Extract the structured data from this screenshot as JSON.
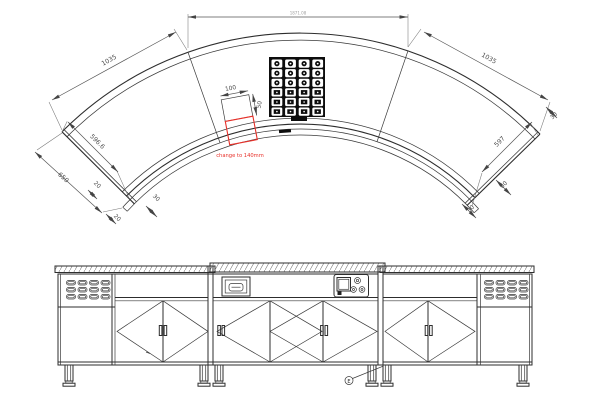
{
  "plan": {
    "dims": {
      "overall_top": "1871.08",
      "segment_left": "1035",
      "segment_right": "1035",
      "end_left_depth": "596.6",
      "end_left_outer": "650",
      "left_small_1": "20",
      "left_small_2": "20",
      "left_small_3": "30",
      "end_right_depth": "597",
      "right_small_60": "60",
      "right_small_30_top": "30",
      "right_small_30_bottom": "30",
      "cutout_width": "100",
      "cutout_depth": "50"
    },
    "revision_note": "change to 140mm"
  },
  "elevation": {
    "reference_mark": "E"
  },
  "colors": {
    "line": "#2d2d2d",
    "dim_line": "#555555",
    "dim_text": "#4a4a4a",
    "note_red": "#e8312a",
    "panel_black": "#0d0d0d"
  }
}
